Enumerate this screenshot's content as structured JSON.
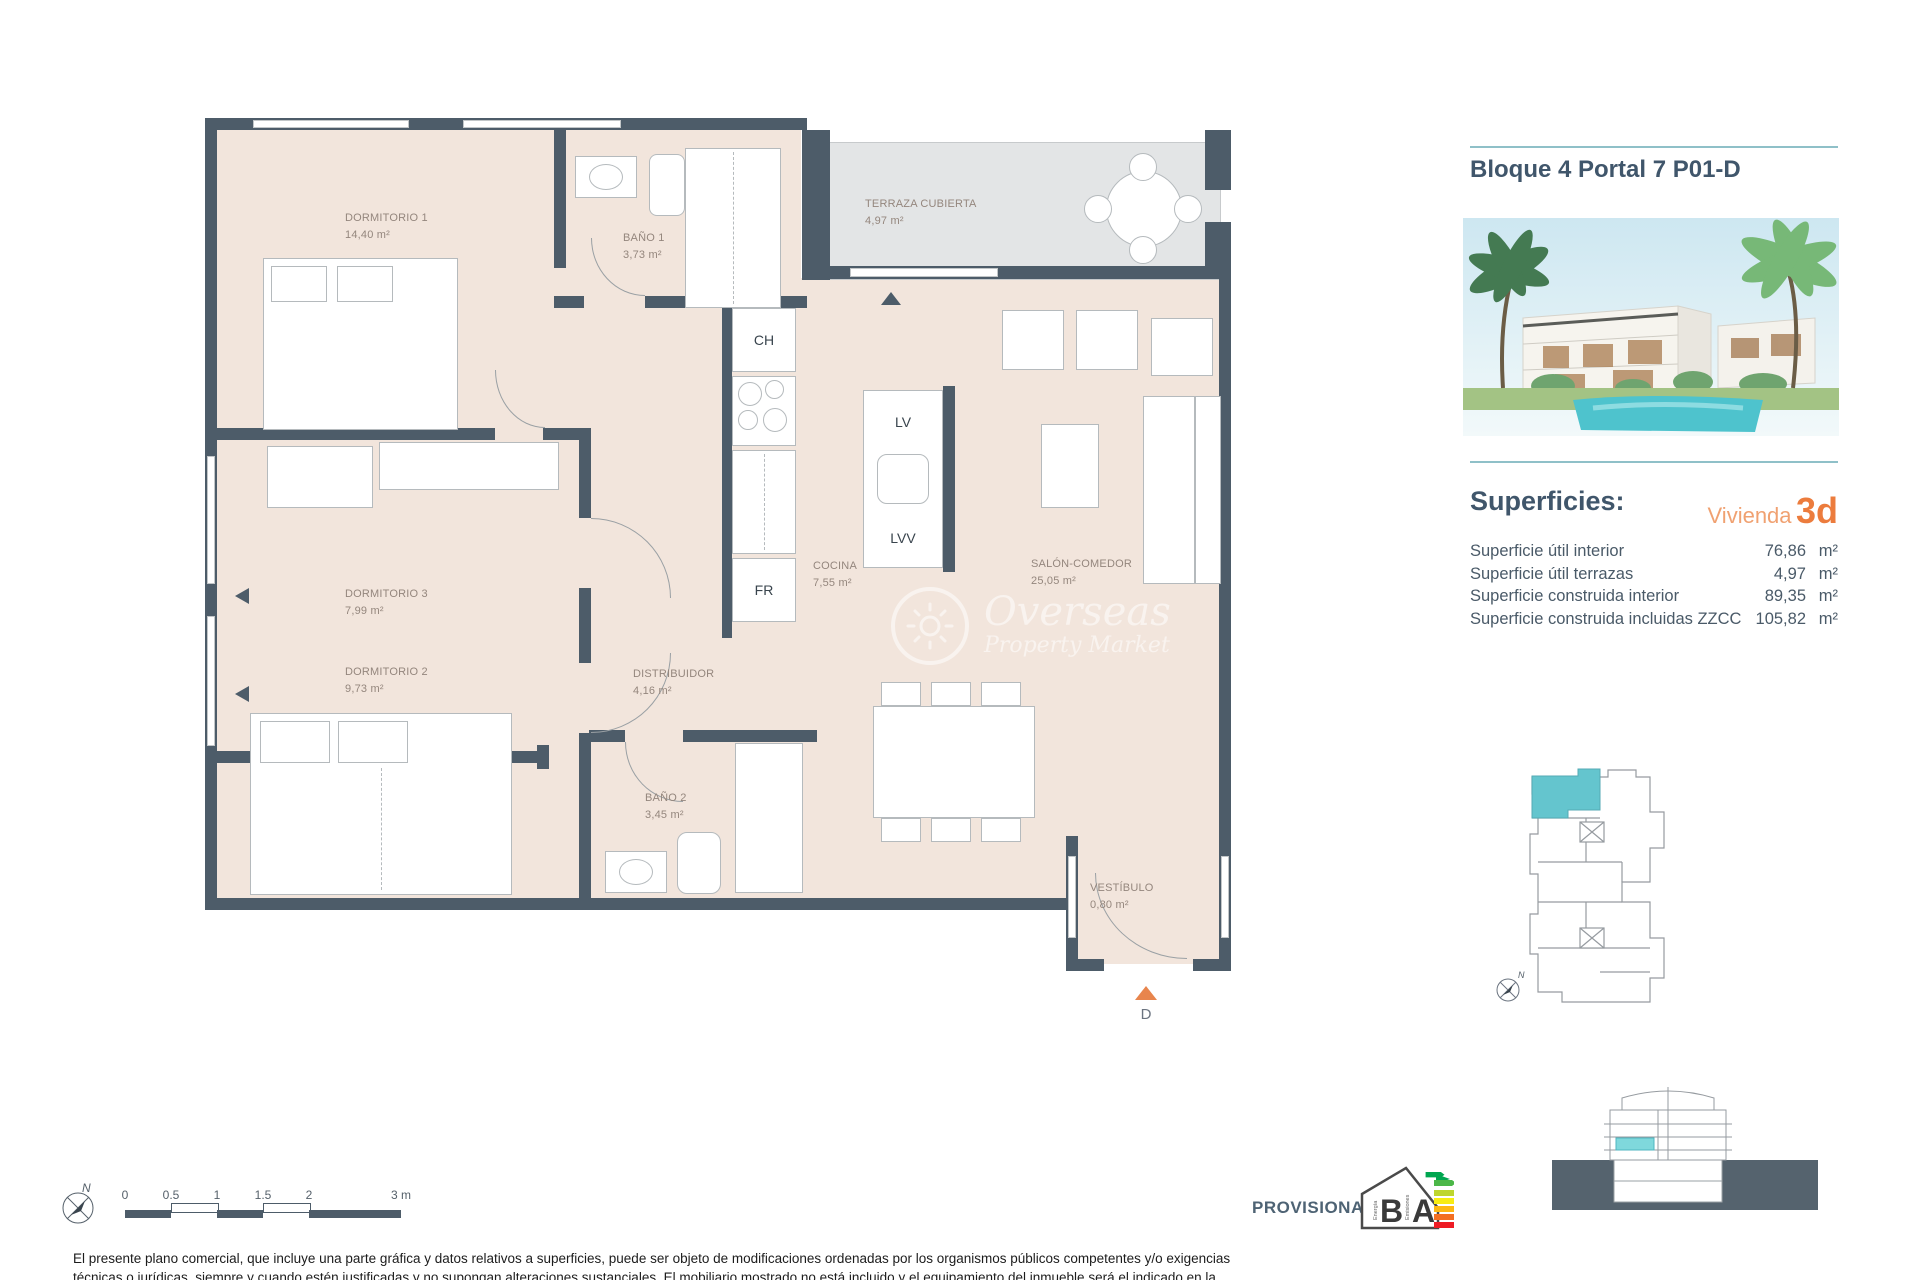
{
  "sidebar": {
    "title": "Bloque 4 Portal 7 P01-D",
    "superficies_heading": "Superficies:",
    "vivienda_label": "Vivienda",
    "vivienda_value": "3d",
    "surface_rows": [
      {
        "label": "Superficie útil interior",
        "value": "76,86",
        "unit": "m²"
      },
      {
        "label": "Superficie útil terrazas",
        "value": "4,97",
        "unit": "m²"
      },
      {
        "label": "Superficie construida interior",
        "value": "89,35",
        "unit": "m²"
      },
      {
        "label": "Superficie construida incluidas ZZCC",
        "value": "105,82",
        "unit": "m²"
      }
    ]
  },
  "plan": {
    "rooms": [
      {
        "name": "DORMITORIO 1",
        "area": "14,40 m²"
      },
      {
        "name": "BAÑO 1",
        "area": "3,73 m²"
      },
      {
        "name": "TERRAZA CUBIERTA",
        "area": "4,97 m²"
      },
      {
        "name": "DORMITORIO 3",
        "area": "7,99 m²"
      },
      {
        "name": "DORMITORIO 2",
        "area": "9,73 m²"
      },
      {
        "name": "DISTRIBUIDOR",
        "area": "4,16 m²"
      },
      {
        "name": "COCINA",
        "area": "7,55 m²"
      },
      {
        "name": "SALÓN-COMEDOR",
        "area": "25,05 m²"
      },
      {
        "name": "BAÑO 2",
        "area": "3,45 m²"
      },
      {
        "name": "VESTÍBULO",
        "area": "0,80 m²"
      }
    ],
    "fixtures": {
      "ch": "CH",
      "lv": "LV",
      "lvv": "LVV",
      "fr": "FR"
    },
    "entrance_label": "D",
    "north": "N"
  },
  "watermark": {
    "line1": "Overseas",
    "line2": "Property Market"
  },
  "scalebar": {
    "labels": [
      "0",
      "0.5",
      "1",
      "1.5",
      "2",
      "3 m"
    ],
    "north": "N"
  },
  "footer": {
    "provisional": "PROVISIONAL",
    "energy": {
      "letter_b": "B",
      "letter_a": "A",
      "word_energia": "Energía",
      "word_emisiones": "Emisiones"
    },
    "disclaimer_line1": "El presente plano comercial, que incluye una parte gráfica y datos relativos a superficies, puede ser objeto de modificaciones ordenadas por los organismos públicos competentes y/o exigencias",
    "disclaimer_line2": "técnicas o jurídicas, siempre y cuando estén justificadas y no supongan alteraciones sustanciales. El mobiliario mostrado no está incluido y el equipamiento del inmueble será el indicado en la"
  },
  "colors": {
    "wall": "#4D5C69",
    "floor": "#F2E5DC",
    "terrace": "#E3E5E6",
    "accent_teal": "#8FC0C8",
    "accent_orange": "#EC7C3D",
    "highlight_unit": "#64C5CE",
    "title_blue": "#40566B"
  }
}
